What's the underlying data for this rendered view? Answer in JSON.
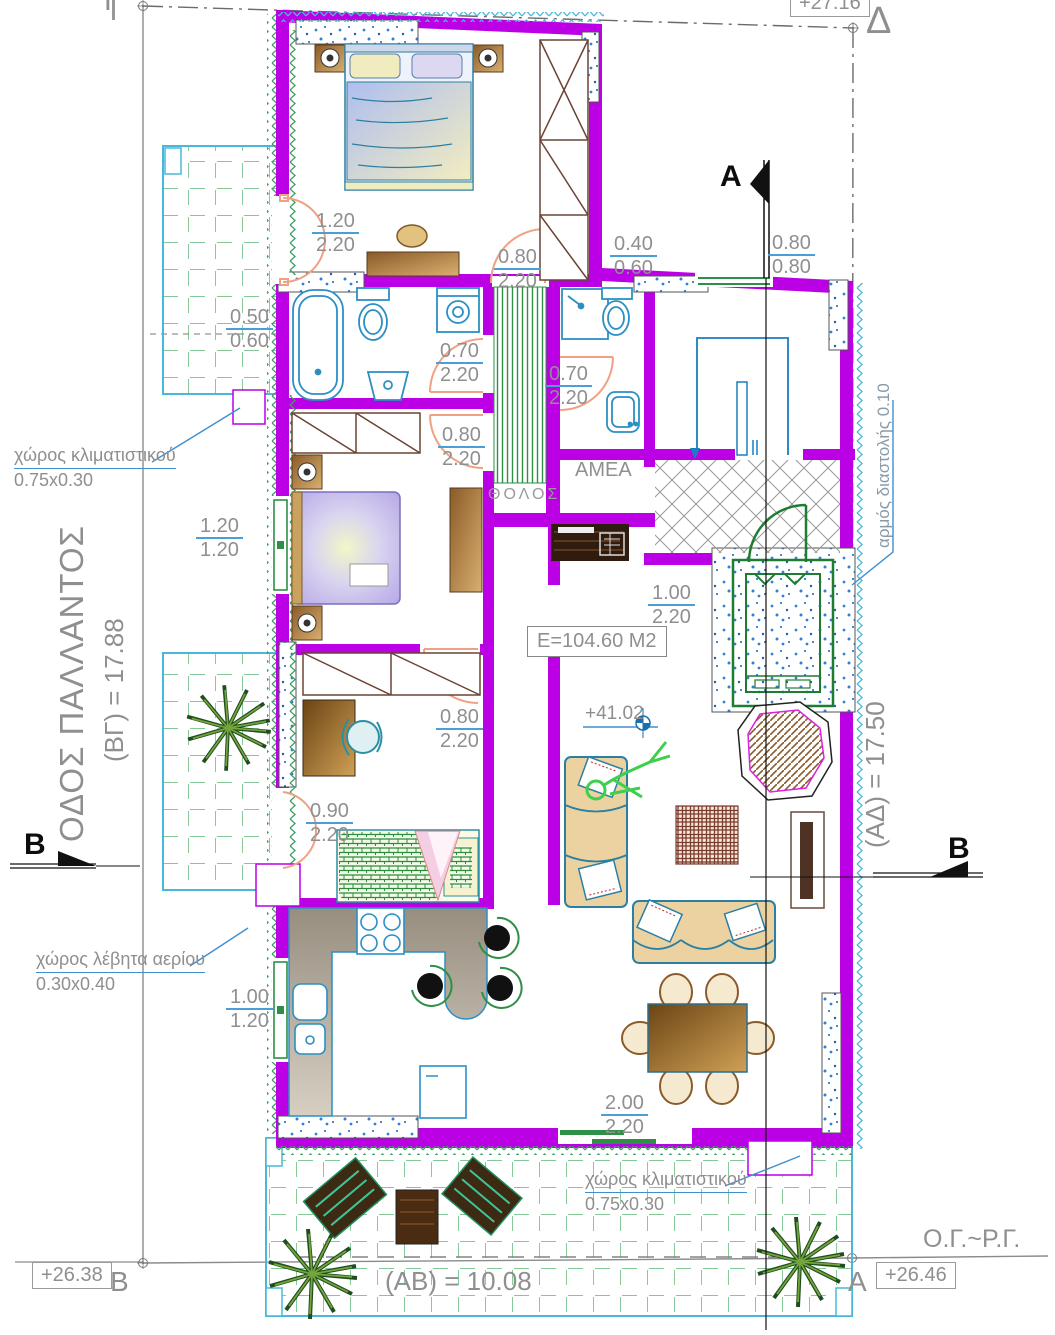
{
  "labels": {
    "gamma": "Γ",
    "delta": "Δ",
    "section_a": "A",
    "section_b_left": "B",
    "section_b_right": "B",
    "corner_b": "B",
    "corner_a": "A",
    "level_top": "+27.16",
    "level_b": "+26.38",
    "level_a": "+26.46",
    "level_floor": "+41.02",
    "street": "ΟΔΟΣ ΠΑΛΛΑΝΤΟΣ",
    "side_bg": "(ΒΓ) = 17.88",
    "side_ad": "(ΑΔ) = 17.50",
    "side_ab": "(ΑΒ) = 10.08",
    "building_lines": "Ο.Γ.~Ρ.Γ.",
    "area": "Ε=104.60 Μ2",
    "tholos": "ΘΟΛΟΣ",
    "amea": "ΑΜΕΑ",
    "expansion_joint": "αρμός διαστολής 0.10"
  },
  "notes": {
    "ac_left": {
      "l1": "χώρος κλιματιστικού",
      "l2": "0.75x0.30"
    },
    "boiler": {
      "l1": "χώρος λέβητα αερίου",
      "l2": "0.30x0.40"
    },
    "ac_bottom": {
      "l1": "χώρος κλιματιστικού",
      "l2": "0.75x0.30"
    }
  },
  "dims": [
    {
      "top": "1.20",
      "bottom": "2.20"
    },
    {
      "top": "0.80",
      "bottom": "2.20"
    },
    {
      "top": "0.40",
      "bottom": "0.60"
    },
    {
      "top": "0.80",
      "bottom": "0.80"
    },
    {
      "top": "0.50",
      "bottom": "0.60"
    },
    {
      "top": "0.70",
      "bottom": "2.20"
    },
    {
      "top": "0.70",
      "bottom": "2.20"
    },
    {
      "top": "0.80",
      "bottom": "2.20"
    },
    {
      "top": "1.20",
      "bottom": "1.20"
    },
    {
      "top": "1.00",
      "bottom": "2.20"
    },
    {
      "top": "0.80",
      "bottom": "2.20"
    },
    {
      "top": "0.90",
      "bottom": "2.20"
    },
    {
      "top": "1.00",
      "bottom": "1.20"
    },
    {
      "top": "2.00",
      "bottom": "2.20"
    }
  ],
  "colors": {
    "wall": "#bb00e6",
    "door": "#f0a183",
    "fixture": "#2b8fc4",
    "green": "#2e8f46",
    "text": "#8f8f8f",
    "dim_line": "#4c9fd6",
    "insulation_green": "#3f9e63",
    "insulation_cyan": "#49b8d8"
  }
}
